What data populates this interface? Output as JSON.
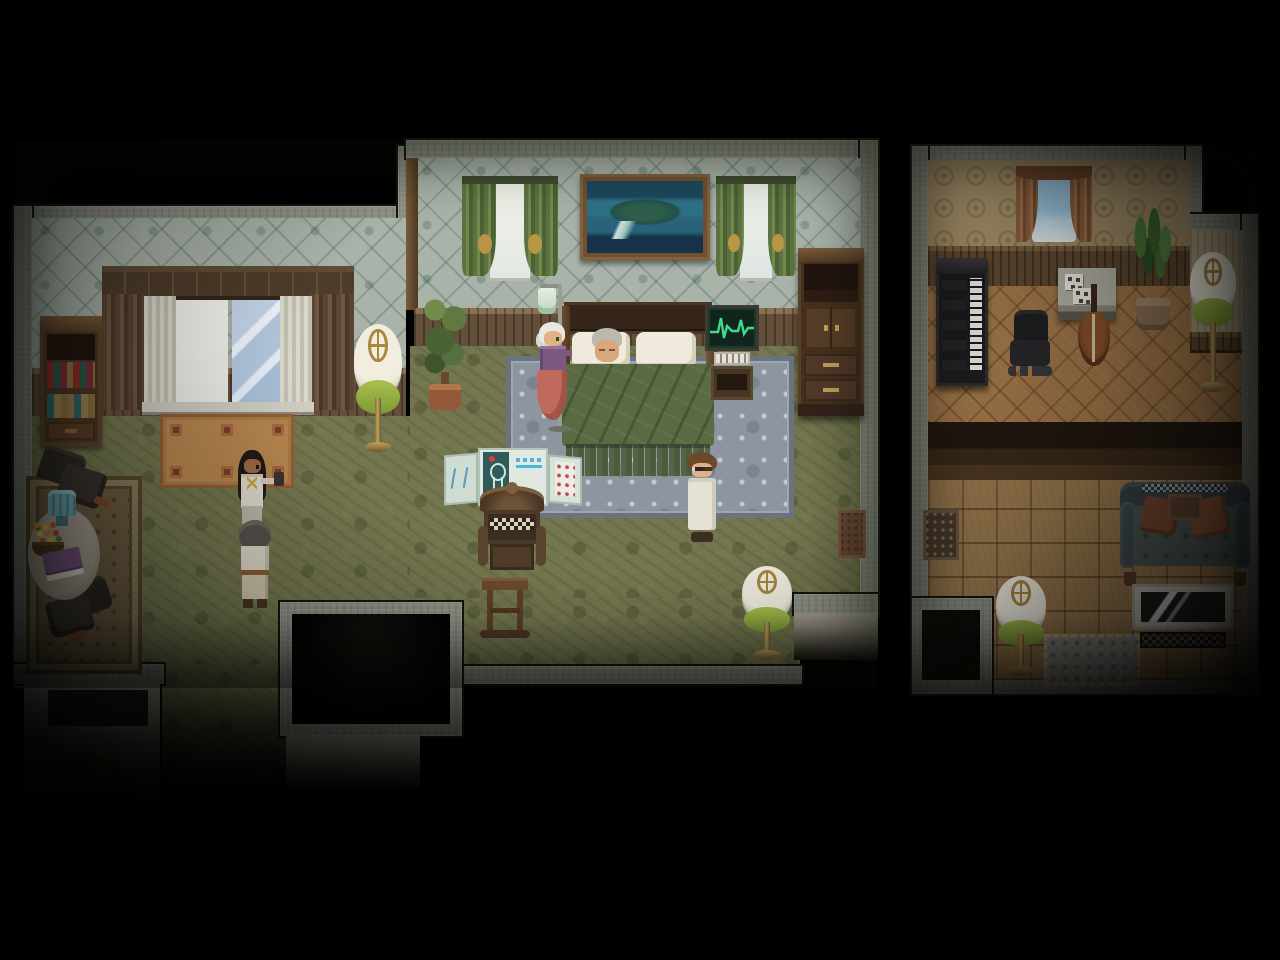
{
  "meta": {
    "style": "16-bit top-down RPG interior (RPG-Maker style pixel art)",
    "lighting": "dim warm interior light, heavy black vignette at screen edges and bottom",
    "visible_text": "none (no HUD, no readable labels; folding-screen glyphs are illegible pixels)"
  },
  "palette": {
    "background": "#000000",
    "bedroom_wallpaper": "#a9b3a9",
    "bedroom_wallpaper_pattern": "#5e7365",
    "bedroom_carpet": "#73764e",
    "wainscot_wood": "#64503a",
    "bed_quilt": "#5a6b44",
    "bed_rug": "#8d95a1",
    "monitor_trace": "#43d98e",
    "curtain_green": "#5c7340",
    "lamp_shade_rim": "#8cab3f",
    "music_room_wallpaper": "#a5906a",
    "music_room_floor": "#a2784a",
    "den_floor_tile": "#9b7b4f",
    "wall_stone": "#8d9084",
    "iv_skirt_salmon": "#c06a5c",
    "caregiver_purple": "#7d5880"
  },
  "rooms": {
    "bedroom": {
      "label": "Bedroom with sleeping elder"
    },
    "sitting_nook": {
      "label": "Sitting nook with round table"
    },
    "hallway": {
      "label": "South hallway and stairwell"
    },
    "music_room": {
      "label": "Music room with piano and cello"
    },
    "den": {
      "label": "Den with sofa and television"
    }
  },
  "entities": {
    "big_window": {
      "label": "Large window with brown drapes and sheer curtains"
    },
    "bookshelf": {
      "label": "Bookshelf with red, green and tan books"
    },
    "floor_lamp_a": {
      "label": "Brass floor lamp with green-rimmed shade"
    },
    "tan_rug": {
      "label": "Tan rug with red square motifs"
    },
    "potted_tree": {
      "label": "Potted tree"
    },
    "window_small_left": {
      "label": "Window with green curtains and gold tiebacks"
    },
    "window_small_right": {
      "label": "Window with green curtains and gold tiebacks"
    },
    "painting": {
      "label": "Framed painting of an island in a blue sea"
    },
    "wardrobe": {
      "label": "Tall dark-wood wardrobe with drawers"
    },
    "bed": {
      "label": "Double bed with green quilt"
    },
    "patient": {
      "label": "Elderly person sleeping in bed"
    },
    "caregiver": {
      "label": "White-haired caregiver in purple blouse and salmon skirt holding IV stand"
    },
    "iv_stand": {
      "label": "IV drip stand"
    },
    "heart_monitor": {
      "label": "Heart monitor with green ECG trace on wooden stand"
    },
    "blue_rug": {
      "label": "Blue-grey patterned area rug under bed"
    },
    "doctor_white_coat": {
      "label": "Man with brown hair and glasses in white coat"
    },
    "folding_screen": {
      "label": "Medical folding screen with body chart and notes"
    },
    "ornate_chair": {
      "label": "Carved high-back wooden chair"
    },
    "wood_stand": {
      "label": "Small wooden stand"
    },
    "woman_dark_hair": {
      "label": "Dark-haired woman in pale uniform carrying an item"
    },
    "boy_grey_hair": {
      "label": "Grey-haired boy facing the bed"
    },
    "floor_lamp_b": {
      "label": "Brass floor lamp with green-rimmed shade"
    },
    "east_doormat": {
      "label": "Small brown doormat"
    },
    "area_rug_brown": {
      "label": "Ornate brown area rug"
    },
    "dark_chair_top": {
      "label": "Dark upholstered chair"
    },
    "dark_chair_bottom": {
      "label": "Dark upholstered chair"
    },
    "round_table": {
      "label": "Round side table"
    },
    "teal_lamp": {
      "label": "Teal table lamp"
    },
    "flower_basket": {
      "label": "Basket of orange flowers"
    },
    "purple_book": {
      "label": "Purple book"
    },
    "stairwell": {
      "label": "Dark stairwell opening"
    },
    "wall_satchel": {
      "label": "Small satchel on lower wall"
    },
    "music_window": {
      "label": "Window with brown curtains"
    },
    "piano": {
      "label": "Upright piano"
    },
    "office_chair": {
      "label": "Black swivel chair"
    },
    "music_desk": {
      "label": "Desk with sheet music"
    },
    "cello": {
      "label": "Cello"
    },
    "potted_plant": {
      "label": "Large leafy potted plant"
    },
    "floor_lamp_c": {
      "label": "Brass floor lamp with green-rimmed shade"
    },
    "floor_lamp_d": {
      "label": "Brass floor lamp with green-rimmed shade"
    },
    "small_rug": {
      "label": "Small dark patterned rug"
    },
    "sofa": {
      "label": "Tufted sofa with two rust cushions"
    },
    "television": {
      "label": "Television on low stand"
    },
    "fringe_rug": {
      "label": "Grey rug with tan fringe"
    }
  }
}
